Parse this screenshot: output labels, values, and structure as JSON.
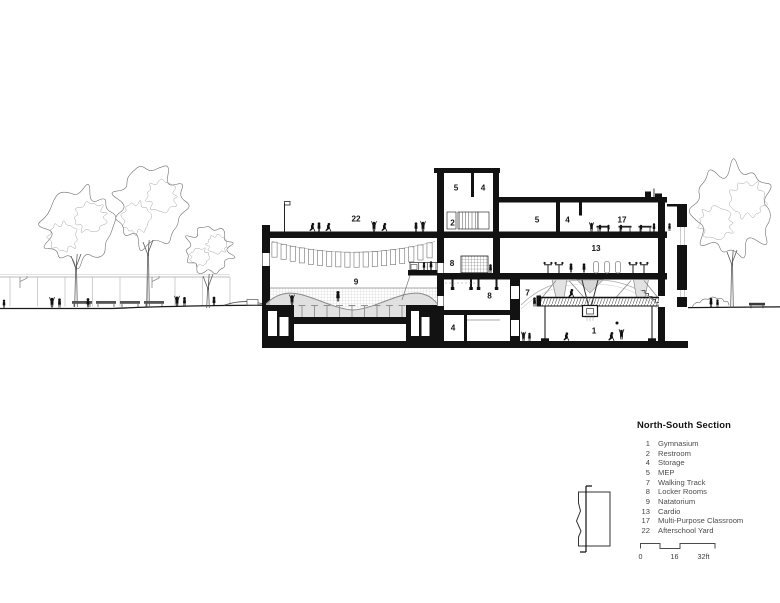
{
  "legend": {
    "title": "North-South Section",
    "items": [
      {
        "num": "1",
        "name": "Gymnasium"
      },
      {
        "num": "2",
        "name": "Restroom"
      },
      {
        "num": "4",
        "name": "Storage"
      },
      {
        "num": "5",
        "name": "MEP"
      },
      {
        "num": "7",
        "name": "Walking Track"
      },
      {
        "num": "8",
        "name": "Locker Rooms"
      },
      {
        "num": "9",
        "name": "Natatorium"
      },
      {
        "num": "13",
        "name": "Cardio"
      },
      {
        "num": "17",
        "name": "Multi-Purpose Classroom"
      },
      {
        "num": "22",
        "name": "Afterschool Yard"
      }
    ]
  },
  "scale_bar": {
    "tick_0": "0",
    "tick_16": "16",
    "tick_32": "32ft"
  },
  "drawing": {
    "labels": [
      {
        "num": "5"
      },
      {
        "num": "4"
      },
      {
        "num": "2"
      },
      {
        "num": "5"
      },
      {
        "num": "4"
      },
      {
        "num": "17"
      },
      {
        "num": "13"
      },
      {
        "num": "8"
      },
      {
        "num": "8"
      },
      {
        "num": "4"
      },
      {
        "num": "22"
      },
      {
        "num": "9"
      },
      {
        "num": "7"
      },
      {
        "num": "1"
      }
    ]
  },
  "colors": {
    "ink": "#121212",
    "light_line": "#9a9a9a",
    "shade": "#dcdcdc",
    "water_hatch": "#c9c9c9"
  }
}
